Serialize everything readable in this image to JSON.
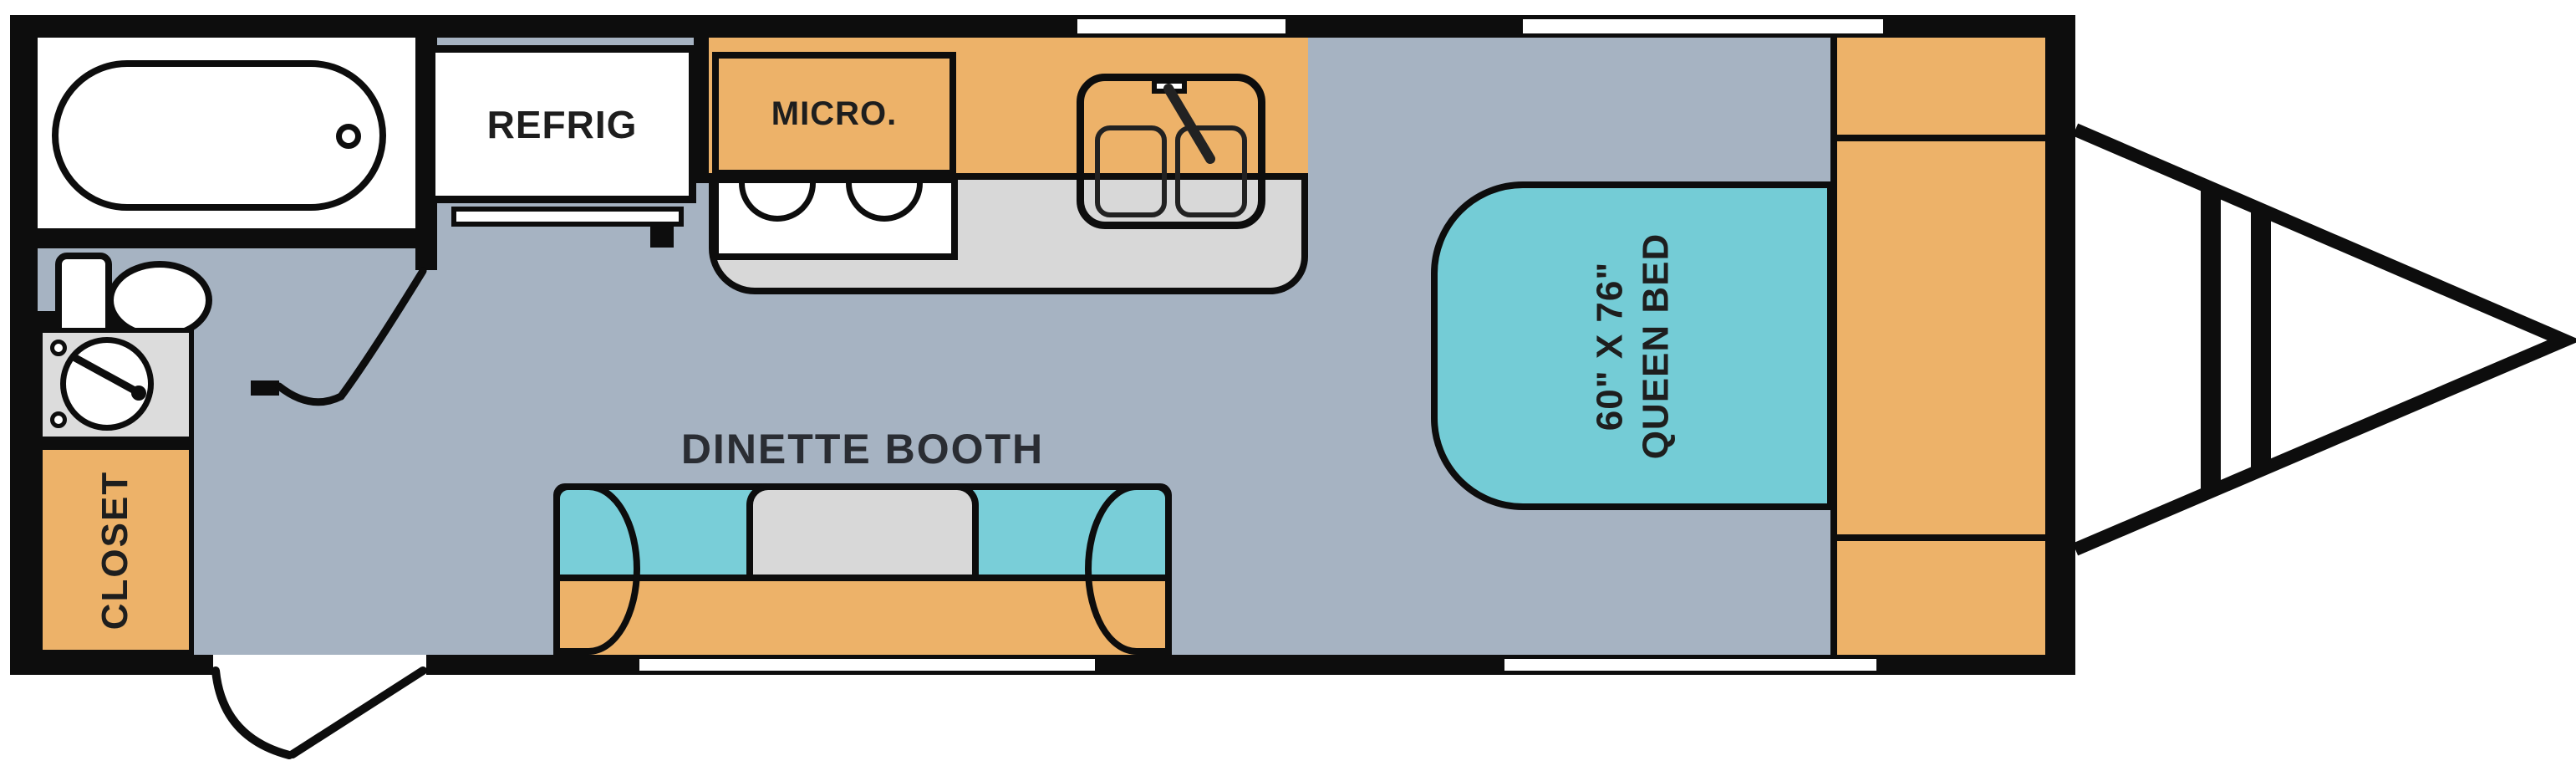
{
  "diagram": {
    "type": "travel-trailer-floor-plan",
    "labels": {
      "refrigerator": "REFRIG",
      "microwave": "MICRO.",
      "dinette": "DINETTE BOOTH",
      "closet": "CLOSET",
      "bed_size": "60\" X 76\"",
      "bed_type": "QUEEN BED"
    },
    "features": [
      "bathtub",
      "toilet",
      "water-heater",
      "closet",
      "refrigerator",
      "microwave",
      "stove",
      "double-sink",
      "kitchen-counter",
      "dinette-booth",
      "queen-bed",
      "front-storage",
      "entry-door",
      "bathroom-door",
      "windows",
      "a-frame-hitch"
    ],
    "colors": {
      "floor": "#a6b3c2",
      "cabinetry": "#edb269",
      "upholstery": "#79ced8",
      "bed": "#74ccd6",
      "counter": "#d8d8d8",
      "outline": "#0d0d0d",
      "exterior": "#ffffff"
    }
  }
}
